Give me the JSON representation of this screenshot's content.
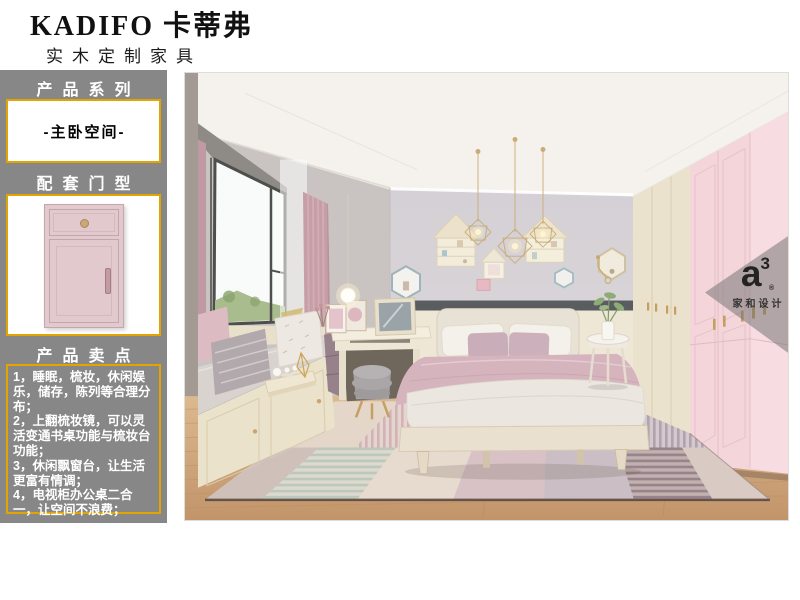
{
  "header": {
    "brand": "KADIFO 卡蒂弗",
    "subtitle": "实木定制家具"
  },
  "sidebar": {
    "series_section_title": "产品系列",
    "series_value": "-主卧空间-",
    "door_section_title": "配套门型",
    "points_section_title": "产品卖点",
    "selling_points": [
      "1，睡眠，梳妆，休闲娱乐，储存，陈列等合理分布；",
      "2，上翻梳妆镜，可以灵活变通书桌功能与梳妆台功能；",
      "3，休闲飘窗台，让生活更富有情调；",
      "4，电视柜办公桌二合一，让空间不浪费；"
    ]
  },
  "photo": {
    "watermark_logo": "a",
    "watermark_logo_sup": "3",
    "watermark_reg": "®",
    "watermark_name": "家和设计"
  },
  "palette": {
    "sidebar_gray": "#878787",
    "accent_gold": "#E2A400",
    "door_pink": "#E2C9CD",
    "wardrobe_pink": "#F3D5DA",
    "wardrobe_cream": "#EBE2CD",
    "wall_gray": "#D6D2D6",
    "curtain_pink": "#C59EA8",
    "duvet_pink": "#D6B4BD",
    "floor_wood": "#CFA87C"
  }
}
